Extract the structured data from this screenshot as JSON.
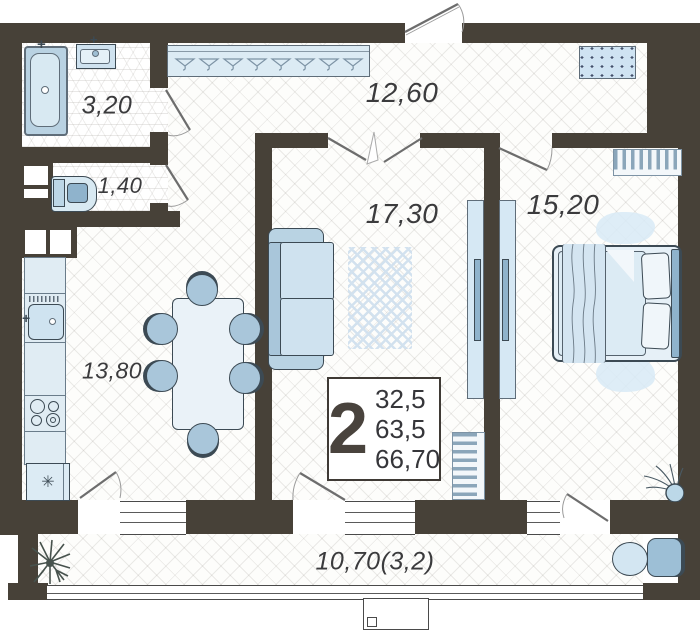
{
  "title": "2-room apartment floor plan",
  "rooms": {
    "bathroom": {
      "area": "3,20"
    },
    "wc": {
      "area": "1,40"
    },
    "hallway": {
      "area": "12,60"
    },
    "living_room": {
      "area": "17,30"
    },
    "bedroom": {
      "area": "15,20"
    },
    "kitchen": {
      "area": "13,80"
    },
    "balcony": {
      "area": "10,70(3,2)"
    }
  },
  "info_box": {
    "room_count": "2",
    "living_area": "32,5",
    "usable_area": "63,5",
    "total_area": "66,70"
  },
  "icons": {
    "fridge_snowflake": "✳",
    "faucet_cross": "+"
  },
  "colors": {
    "wall": "#474138",
    "furniture_light": "#d9e8f1",
    "furniture_mid": "#a9c6da",
    "furniture_dark": "#8fb3cc",
    "outline": "#3c4a54"
  }
}
